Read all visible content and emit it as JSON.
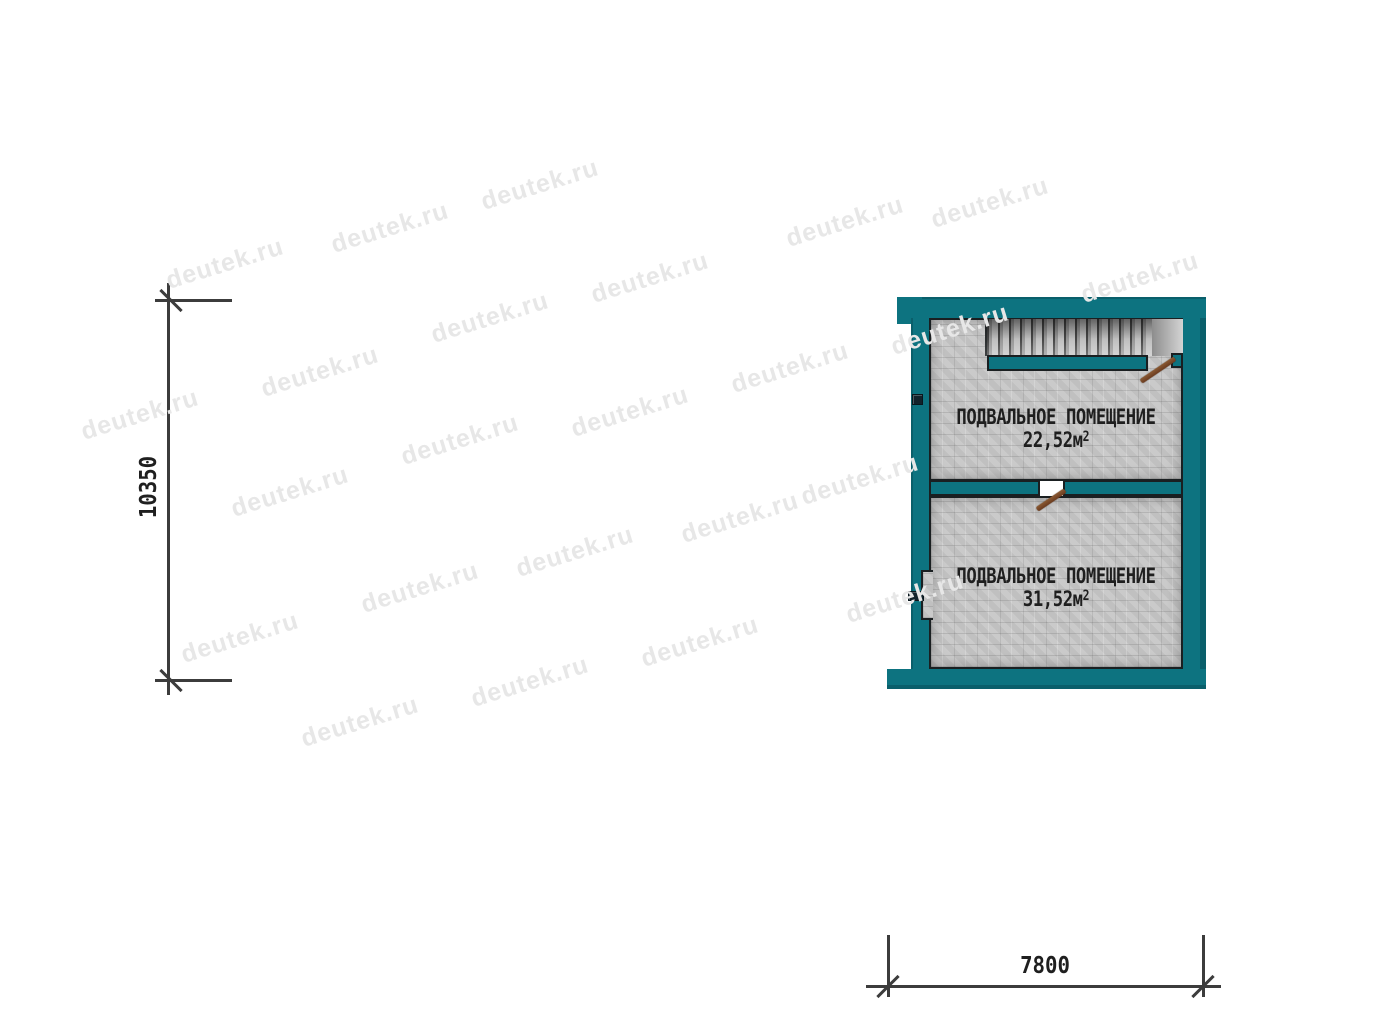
{
  "plan": {
    "rooms": [
      {
        "name": "ПОДВАЛЬНОЕ ПОМЕЩЕНИЕ",
        "area": "22,52м",
        "area_sup": "2"
      },
      {
        "name": "ПОДВАЛЬНОЕ ПОМЕЩЕНИЕ",
        "area": "31,52м",
        "area_sup": "2"
      }
    ]
  },
  "dimensions": {
    "height_label": "10350",
    "width_label": "7800"
  },
  "watermark": {
    "text": "deutek.ru",
    "positions": [
      [
        225,
        264
      ],
      [
        390,
        228
      ],
      [
        540,
        185
      ],
      [
        845,
        222
      ],
      [
        990,
        203
      ],
      [
        1140,
        278
      ],
      [
        140,
        415
      ],
      [
        320,
        372
      ],
      [
        490,
        318
      ],
      [
        650,
        278
      ],
      [
        790,
        368
      ],
      [
        950,
        330
      ],
      [
        290,
        492
      ],
      [
        460,
        440
      ],
      [
        630,
        412
      ],
      [
        740,
        518
      ],
      [
        860,
        480
      ],
      [
        240,
        638
      ],
      [
        420,
        588
      ],
      [
        575,
        552
      ],
      [
        700,
        642
      ],
      [
        905,
        598
      ],
      [
        360,
        722
      ],
      [
        530,
        682
      ]
    ]
  },
  "colors": {
    "wall": "#0d7380",
    "floor": "#c8c8c8",
    "outline": "#1a1f21",
    "door": "#6b3b1f",
    "dimension": "#3c3c3c",
    "label_text": "#1f1f1f",
    "watermark": "#e7e7e7"
  }
}
